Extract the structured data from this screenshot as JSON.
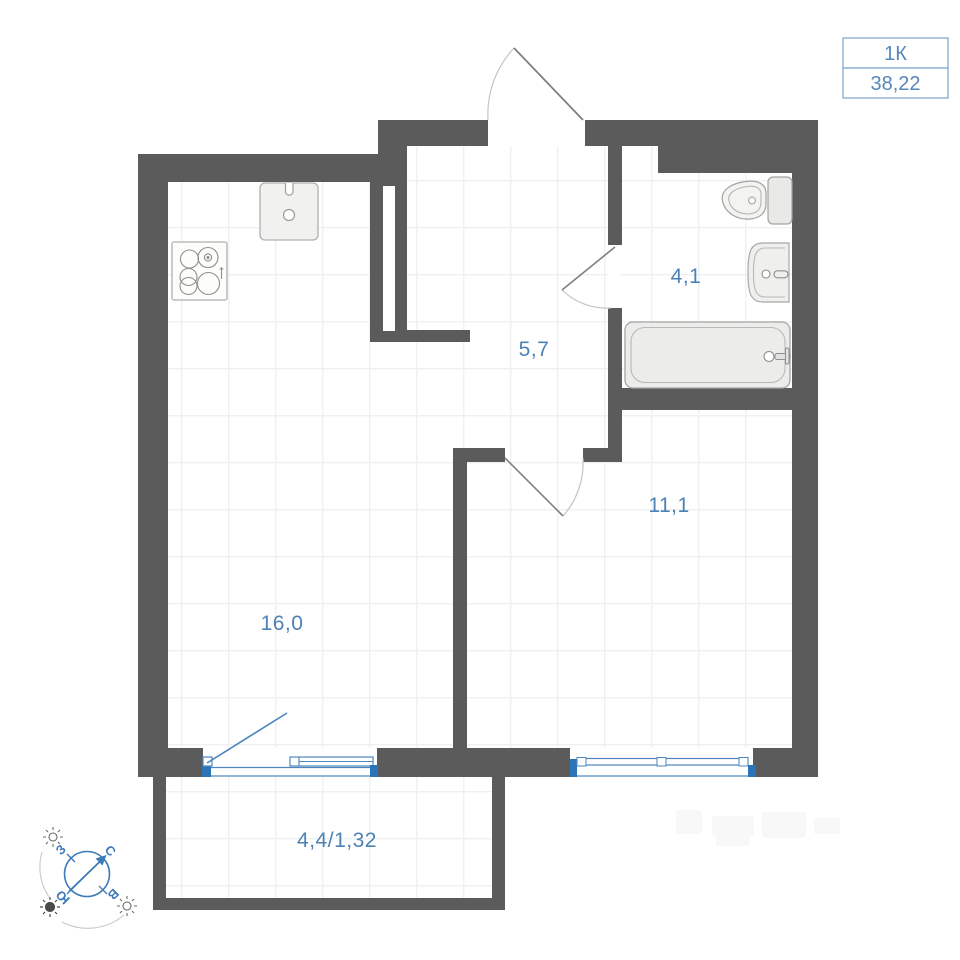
{
  "unit_card": {
    "type": "1К",
    "area": "38,22"
  },
  "rooms": {
    "kitchen_living": {
      "name": "kitchen-living-room",
      "area_label": "16,0"
    },
    "hallway": {
      "name": "hallway",
      "area_label": "5,7"
    },
    "bathroom": {
      "name": "bathroom",
      "area_label": "4,1"
    },
    "bedroom": {
      "name": "room",
      "area_label": "11,1"
    },
    "balcony": {
      "name": "balcony",
      "area_label": "4,4/1,32"
    }
  },
  "compass": {
    "north": "С",
    "east": "В",
    "south": "Ю",
    "west": "З"
  },
  "fixtures": [
    "kitchen-sink",
    "stove",
    "toilet",
    "bathroom-sink",
    "bathtub"
  ],
  "colors": {
    "wall": "#5a5b5a",
    "label_blue": "#4d82b6",
    "window_blue": "#2c74b8",
    "window_line": "#4f86bf",
    "badge_border": "#8fafd2",
    "badge_text": "#5787ba",
    "fixture_outline": "#a3a3a1",
    "fixture_fill": "#f0f0ee",
    "door_leaf": "#7f7f7d",
    "door_arc": "#c4c4c2",
    "grid_line": "#eef1f3",
    "compass_blue": "#3d7ab8"
  }
}
